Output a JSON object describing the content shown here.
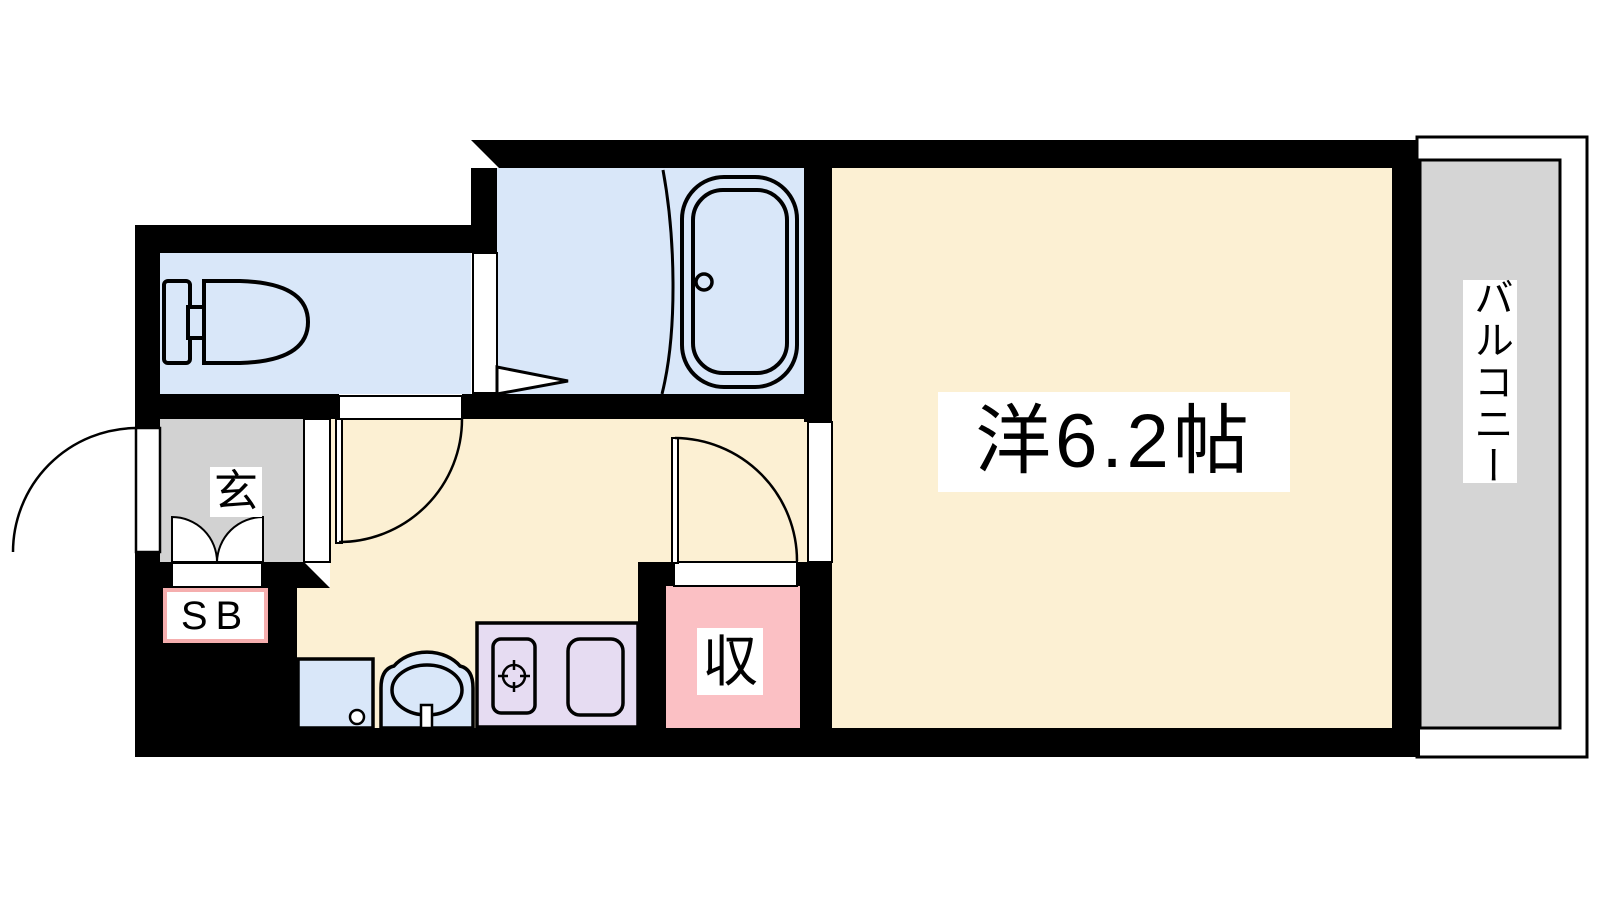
{
  "page": {
    "background": "#ffffff"
  },
  "colors": {
    "wall": "#000000",
    "wet_area_floor": "#d9e7f9",
    "flooring": "#fcf0d3",
    "entrance_floor": "#d2d2d2",
    "balcony_floor": "#d5d5d5",
    "balcony_margin": "#ffffff",
    "closet_floor": "#fbc0c4",
    "kitchen_counter": "#e6dcf2",
    "label_background": "#ffffff",
    "sb_label_border": "#f5aeae",
    "text": "#000000"
  },
  "labels": {
    "main_room": "洋6.2帖",
    "balcony": "バルコニー",
    "entrance": "玄",
    "shoe_box": "SB",
    "closet": "収"
  }
}
